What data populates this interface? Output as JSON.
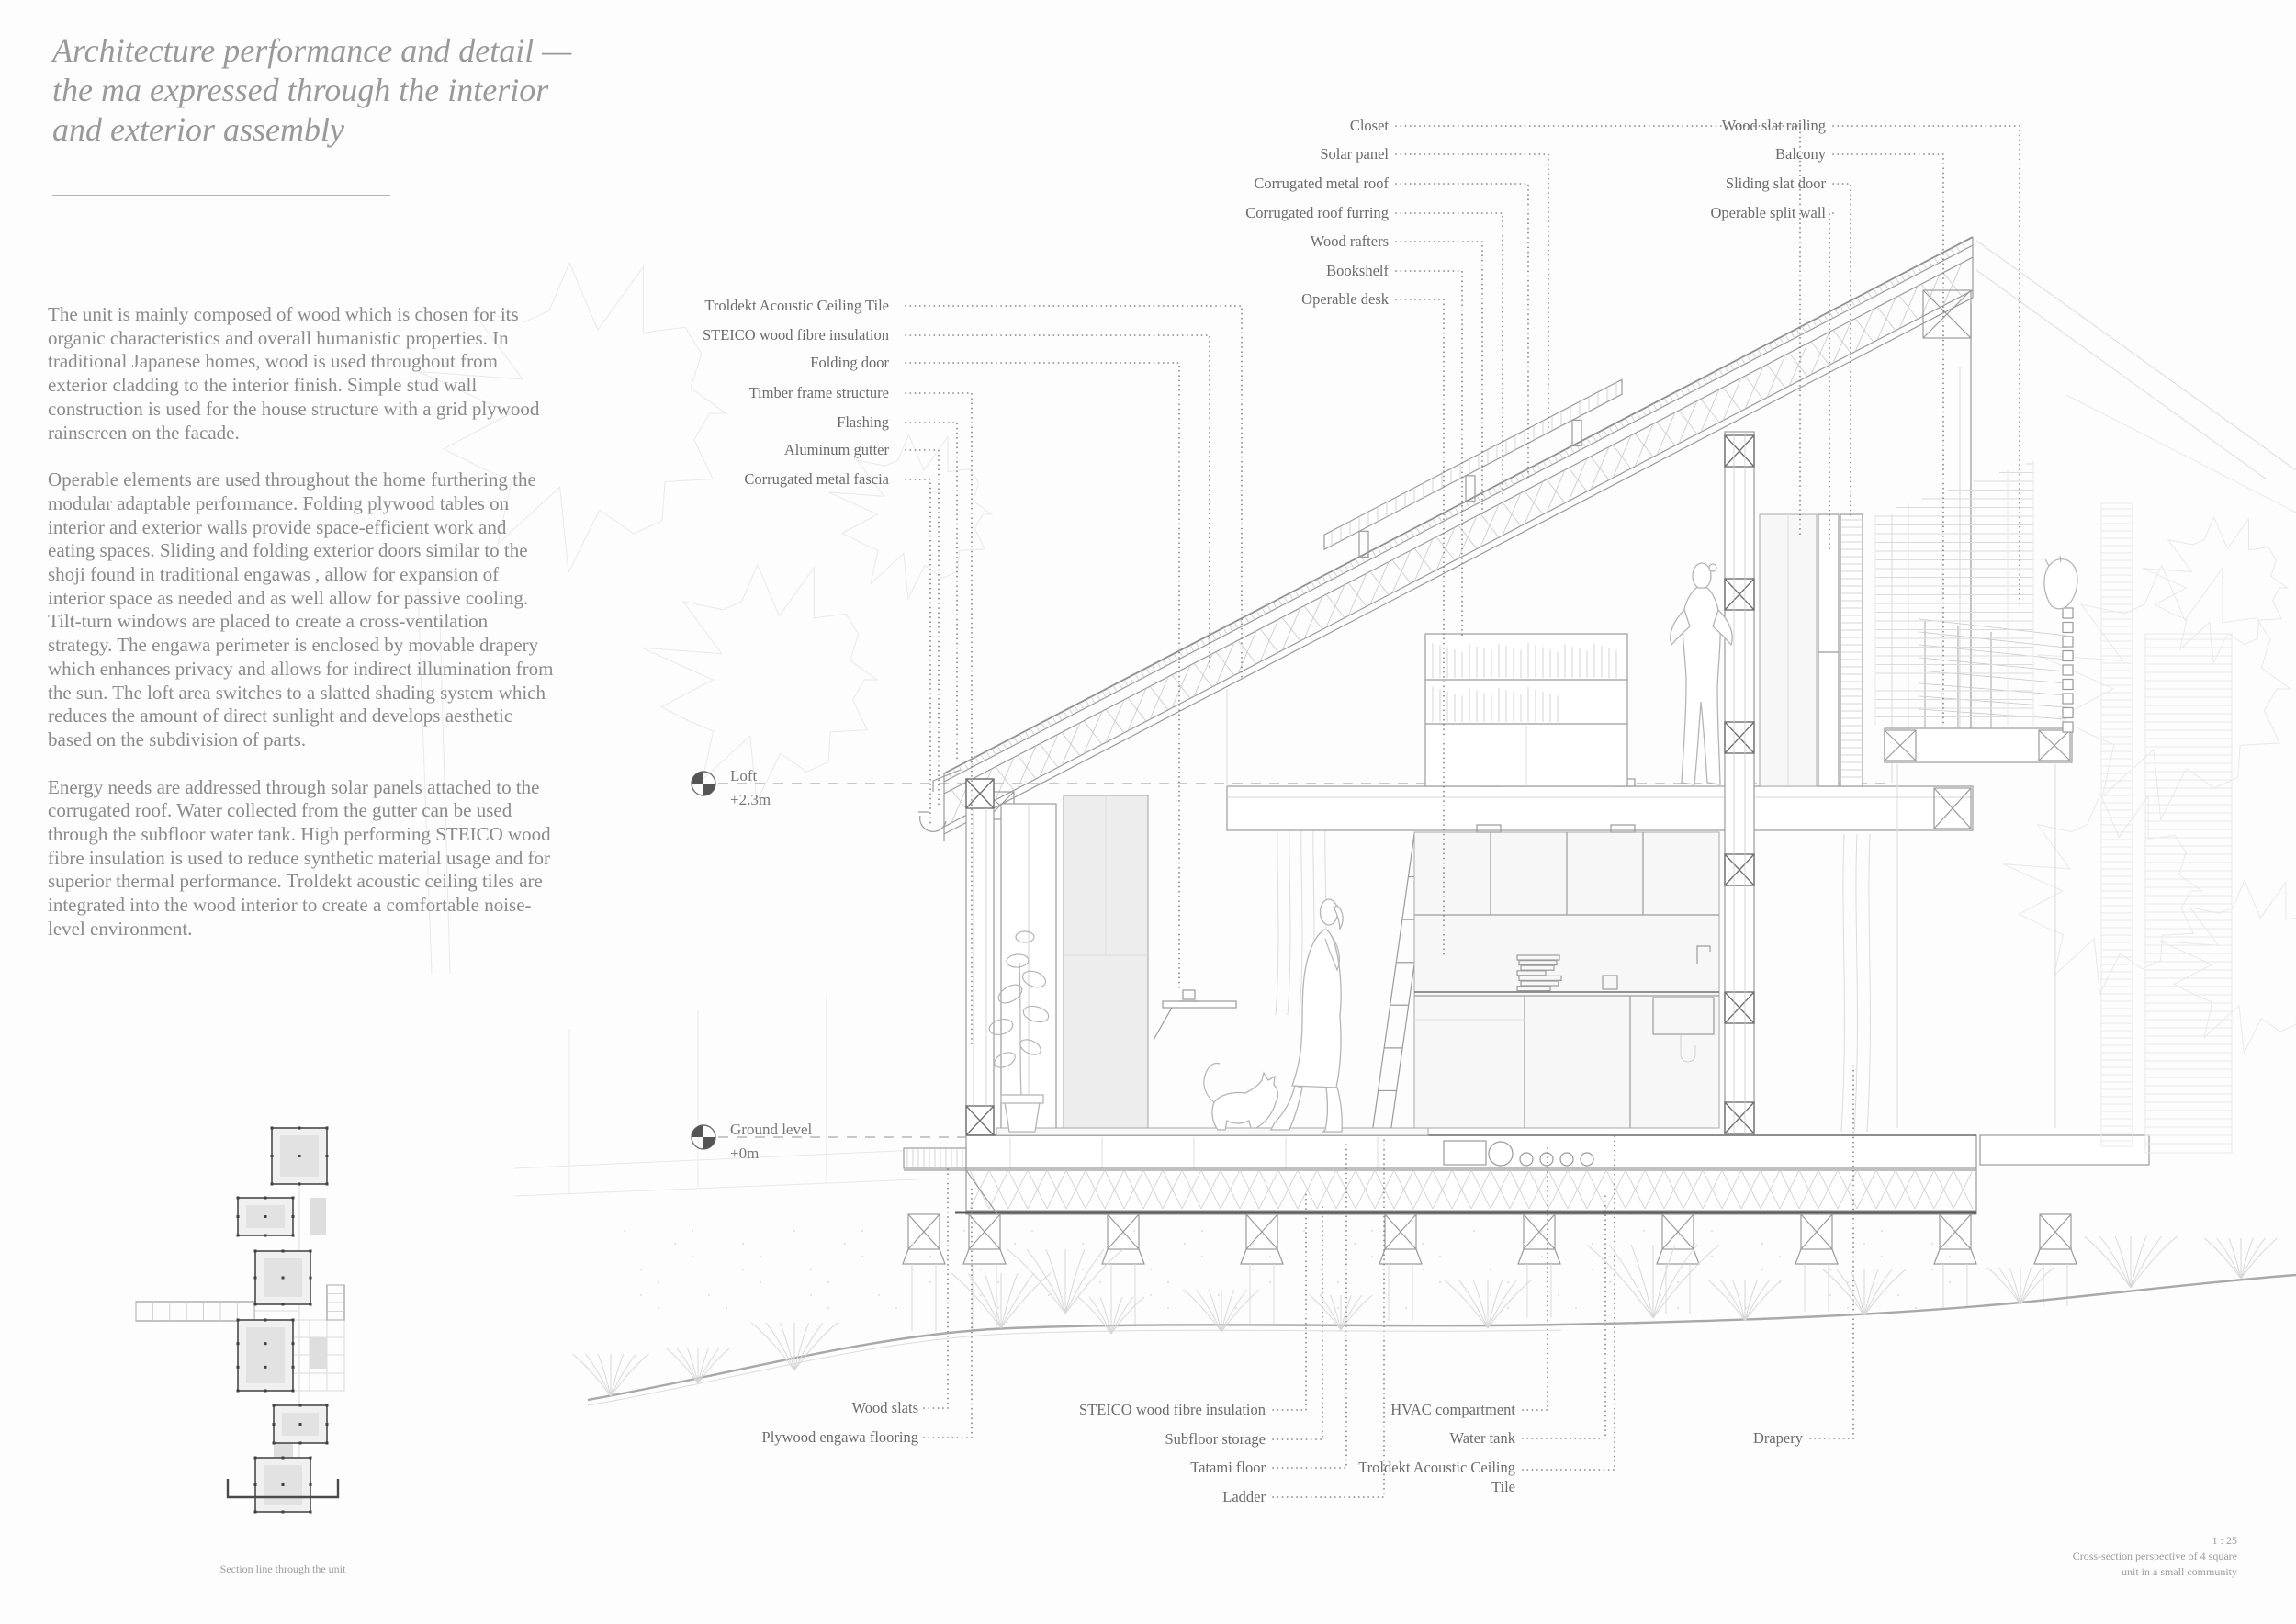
{
  "title": {
    "lines": [
      "Architecture performance and detail  —",
      "the ma expressed through the interior",
      "and exterior assembly"
    ]
  },
  "body": {
    "paragraphs": [
      "The unit is mainly composed of wood which is chosen for its organic characteristics and overall humanistic properties. In traditional Japanese homes, wood is used throughout from exterior cladding to the interior finish. Simple stud wall construction is used for the house structure with a grid plywood rainscreen on the facade.",
      "Operable elements are used throughout the home furthering the modular adaptable performance. Folding plywood tables on interior and exterior walls provide space-efficient work and eating spaces. Sliding and folding exterior doors similar to the shoji found in traditional engawas , allow for expansion of interior space as needed and as well allow for passive cooling. Tilt-turn windows are placed to create a cross-ventilation strategy. The engawa perimeter is enclosed by movable drapery which enhances privacy and allows for indirect illumination from the sun.  The loft area switches to a slatted shading system which reduces the amount of direct sunlight and develops aesthetic based on the subdivision of parts.",
      "Energy needs are addressed through solar panels attached to the corrugated roof. Water collected from the gutter can be used through the subfloor water tank. High performing STEICO wood fibre insulation is used to reduce synthetic material usage and for superior thermal performance. Troldekt acoustic ceiling tiles are integrated into the wood interior to create a comfortable noise-level environment."
    ]
  },
  "levels": {
    "loft": {
      "name": "Loft",
      "elevation": "+2.3m"
    },
    "ground": {
      "name": "Ground level",
      "elevation": "+0m"
    }
  },
  "callouts": {
    "left": [
      "Troldekt Acoustic Ceiling Tile",
      "STEICO wood fibre insulation",
      "Folding door",
      "Timber frame structure",
      "Flashing",
      "Aluminum gutter",
      "Corrugated  metal fascia"
    ],
    "top": [
      "Closet",
      "Solar panel",
      "Corrugated metal roof",
      "Corrugated roof furring",
      "Wood rafters",
      "Bookshelf",
      "Operable desk"
    ],
    "top_right": [
      "Wood slat railing",
      "Balcony",
      "Sliding slat door",
      "Operable split wall"
    ],
    "bottom_left": [
      "Wood slats",
      "Plywood engawa flooring"
    ],
    "bottom_center": [
      "STEICO wood fibre insulation",
      "Subfloor storage",
      "Tatami floor",
      "Ladder"
    ],
    "bottom_right": [
      "HVAC compartment",
      "Water tank",
      "Troldekt Acoustic Ceiling Tile"
    ],
    "bottom_far_right": [
      "Drapery"
    ]
  },
  "captions": {
    "plan": "Section line through the unit",
    "scale": "1 : 25",
    "drawing": [
      "Cross-section perspective of 4 square",
      "unit in a small community"
    ]
  },
  "colors": {
    "ink": "#8a8a8a",
    "line": "#9b9b9b",
    "light_line": "#dcdcdc",
    "cut": "#707070",
    "heavy": "#5a5a5a",
    "fill": "#f0f0f0",
    "marker": "#4a4a4a"
  }
}
